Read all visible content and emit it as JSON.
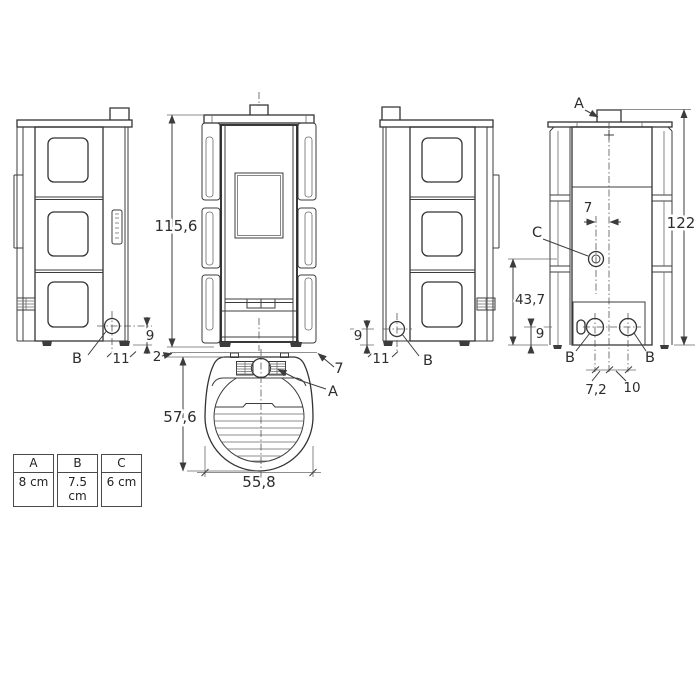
{
  "side_view_left": {
    "dim_outlet_height": "9",
    "dim_outlet_offset": "11",
    "outlet_label": "B"
  },
  "front_view": {
    "dim_height": "115,6"
  },
  "side_view_right": {
    "dim_outlet_height": "9",
    "dim_outlet_offset": "11",
    "outlet_label": "B"
  },
  "rear_view": {
    "flue_label": "A",
    "dim_total_height": "122",
    "dim_center_offset": "7",
    "socket_label": "C",
    "dim_socket_height": "43,7",
    "dim_outlet_height": "9",
    "outlet_left_label": "B",
    "outlet_right_label": "B",
    "dim_outlet_left_offset": "7,2",
    "dim_outlet_right_offset": "10"
  },
  "top_view": {
    "dim_depth": "57,6",
    "dim_width": "55,8",
    "dim_rear_gap": "2",
    "dim_flue_offset": "7",
    "flue_label": "A"
  },
  "legend_table": {
    "headers": [
      "A",
      "B",
      "C"
    ],
    "values": [
      "8 cm",
      "7.5 cm",
      "6 cm"
    ]
  }
}
